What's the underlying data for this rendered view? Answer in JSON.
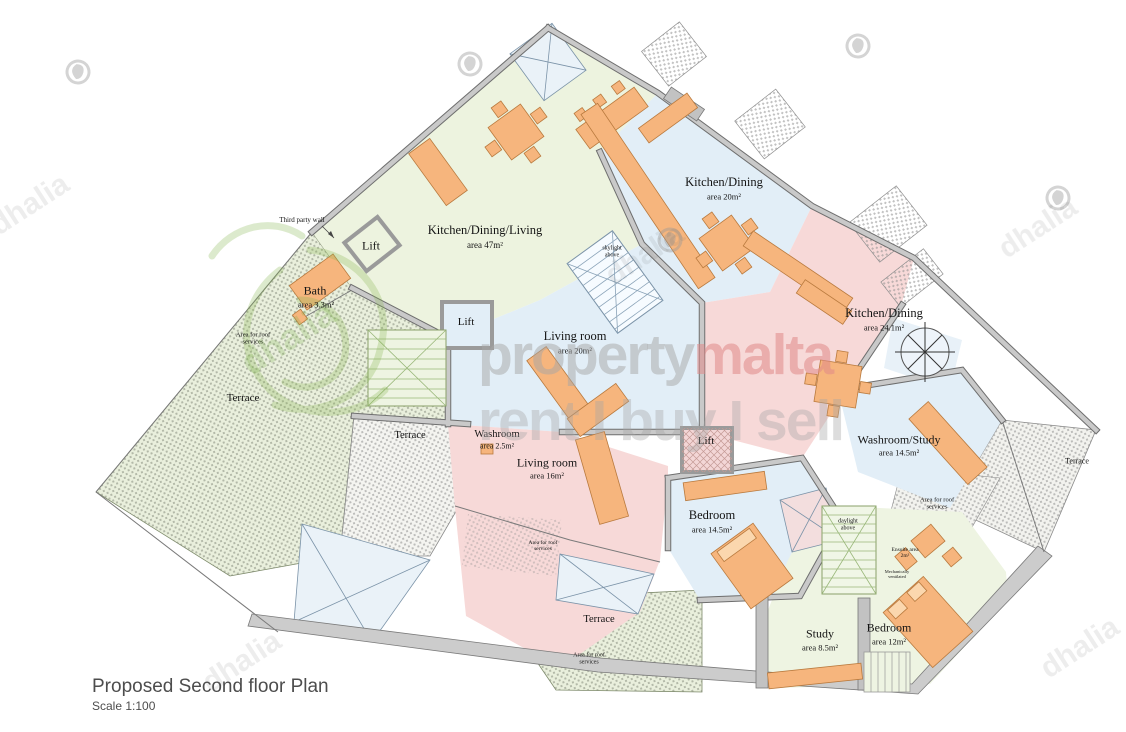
{
  "title": {
    "heading": "Proposed Second floor Plan",
    "scale": "Scale 1:100"
  },
  "rooms": [
    {
      "name": "Kitchen/Dining/Living",
      "area": "area 47m²"
    },
    {
      "name": "Kitchen/Dining",
      "area": "area 20m²"
    },
    {
      "name": "Kitchen/Dining",
      "area": "area 24.1m²"
    },
    {
      "name": "Living room",
      "area": "area 20m²"
    },
    {
      "name": "Living room",
      "area": "area 16m²"
    },
    {
      "name": "Bath",
      "area": "area 3.3m²"
    },
    {
      "name": "Washroom",
      "area": "area 2.5m²"
    },
    {
      "name": "Bedroom",
      "area": "area 14.5m²"
    },
    {
      "name": "Washroom/Study",
      "area": "area 14.5m²"
    },
    {
      "name": "Study",
      "area": "area 8.5m²"
    },
    {
      "name": "Bedroom",
      "area": "area 12m²"
    }
  ],
  "labels": {
    "lift": "Lift",
    "terrace": "Terrace",
    "roof_services": "Area for roof services",
    "skylight": "skylight above",
    "daylight": "daylight above",
    "ensuite": "Ensuite area 2m²",
    "mech_vent": "Mechanically ventilated",
    "third_party_wall": "Third party wall"
  },
  "watermark": {
    "brand_gray": "property",
    "brand_accent": "malta",
    "tagline": "rent I buy I sell",
    "logo_word": "dhalia"
  },
  "colors": {
    "room_green": "#edf3df",
    "room_blue": "#e2eef7",
    "room_pink": "#f7d9d8",
    "furniture_orange": "#f6b57d",
    "wall_gray": "#c6c6c6",
    "watermark_accent": "#e08d88"
  }
}
